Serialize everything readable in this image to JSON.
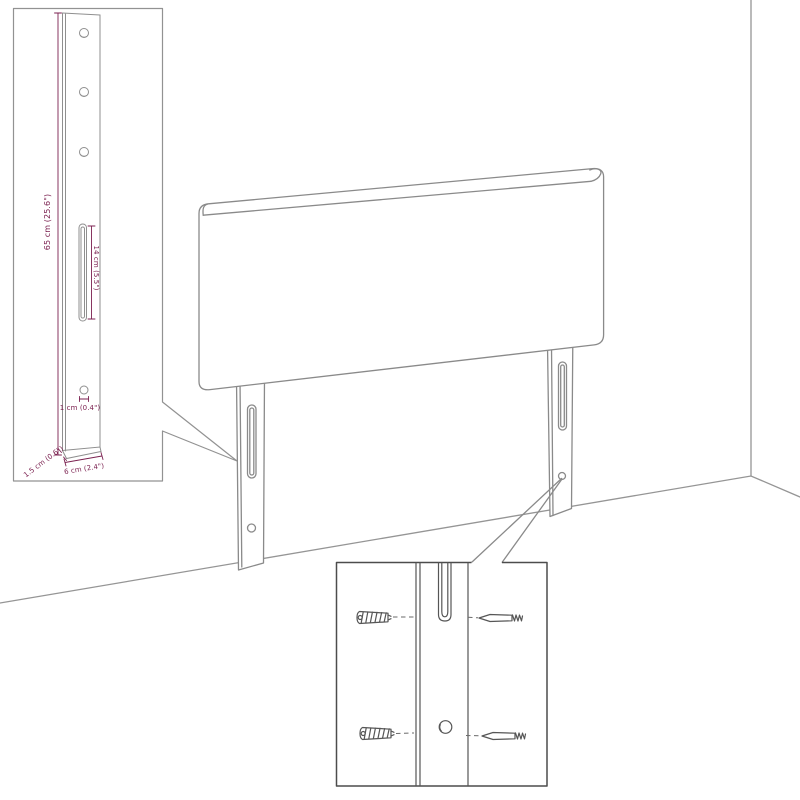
{
  "window": {
    "background": "#ffffff"
  },
  "colors": {
    "dimension_text": "#7b2150",
    "artwork_line": "#8a8a8a",
    "wall_line": "#959595",
    "inset_border": "#929292",
    "detail_box_border": "#4c4c4c"
  },
  "leg_detail_inset": {
    "dim_height": "65 cm (25.6\")",
    "dim_slot": "14 cm (5.5\")",
    "dim_hole": "1 cm (0.4\")",
    "dim_thickness": "1.5 cm (0.6\")",
    "dim_width": "6 cm (2.4\")"
  },
  "mount_detail_inset": {
    "parts": [
      "wall-plug-icon",
      "screw-icon"
    ]
  }
}
